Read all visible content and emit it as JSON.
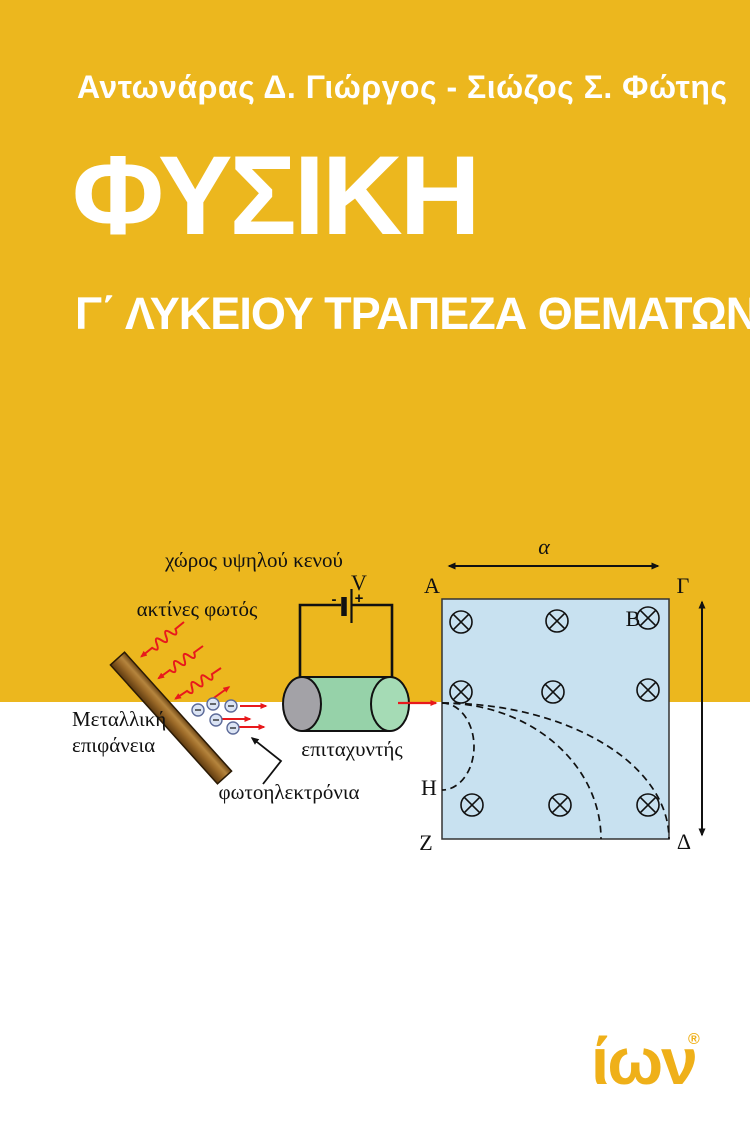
{
  "cover": {
    "authors": "Αντωνάρας Δ. Γιώργος - Σιώζος Σ. Φώτης",
    "title": "ΦΥΣΙΚΗ",
    "subtitle": "Γ΄ ΛΥΚΕΙΟΥ ΤΡΑΠΕΖΑ ΘΕΜΑΤΩΝ"
  },
  "diagram": {
    "vacuum_label": "χώρος υψηλού κενού",
    "light_rays_label": "ακτίνες φωτός",
    "metal_surface_line1": "Μεταλλική",
    "metal_surface_line2": "επιφάνεια",
    "accelerator_label": "επιταχυντής",
    "photoelectrons_label": "φωτοηλεκτρόνια",
    "voltage_label": "V",
    "battery_minus": "-",
    "battery_plus": "+",
    "width_label": "α",
    "corner_a": "A",
    "corner_gamma": "Γ",
    "corner_z": "Z",
    "corner_delta": "Δ",
    "field_point_b": "B",
    "exit_point_h": "H",
    "field_symbol_meaning": "circle-with-x: magnetic field into page"
  },
  "footer": {
    "publisher": "ίων",
    "registered": "®"
  },
  "colors": {
    "cover_yellow": "#ECB71E",
    "logo_yellow": "#EFB019",
    "field_blue": "#C8E1F0",
    "ray_red": "#E8191C",
    "cylinder_green": "#96D2A9",
    "cylinder_cap_green": "#A5DBB5",
    "cylinder_gray": "#A3A2A7",
    "bar_brown": "#9C6A28",
    "text_white": "#FFFFFF",
    "diagram_ink": "#111111"
  }
}
